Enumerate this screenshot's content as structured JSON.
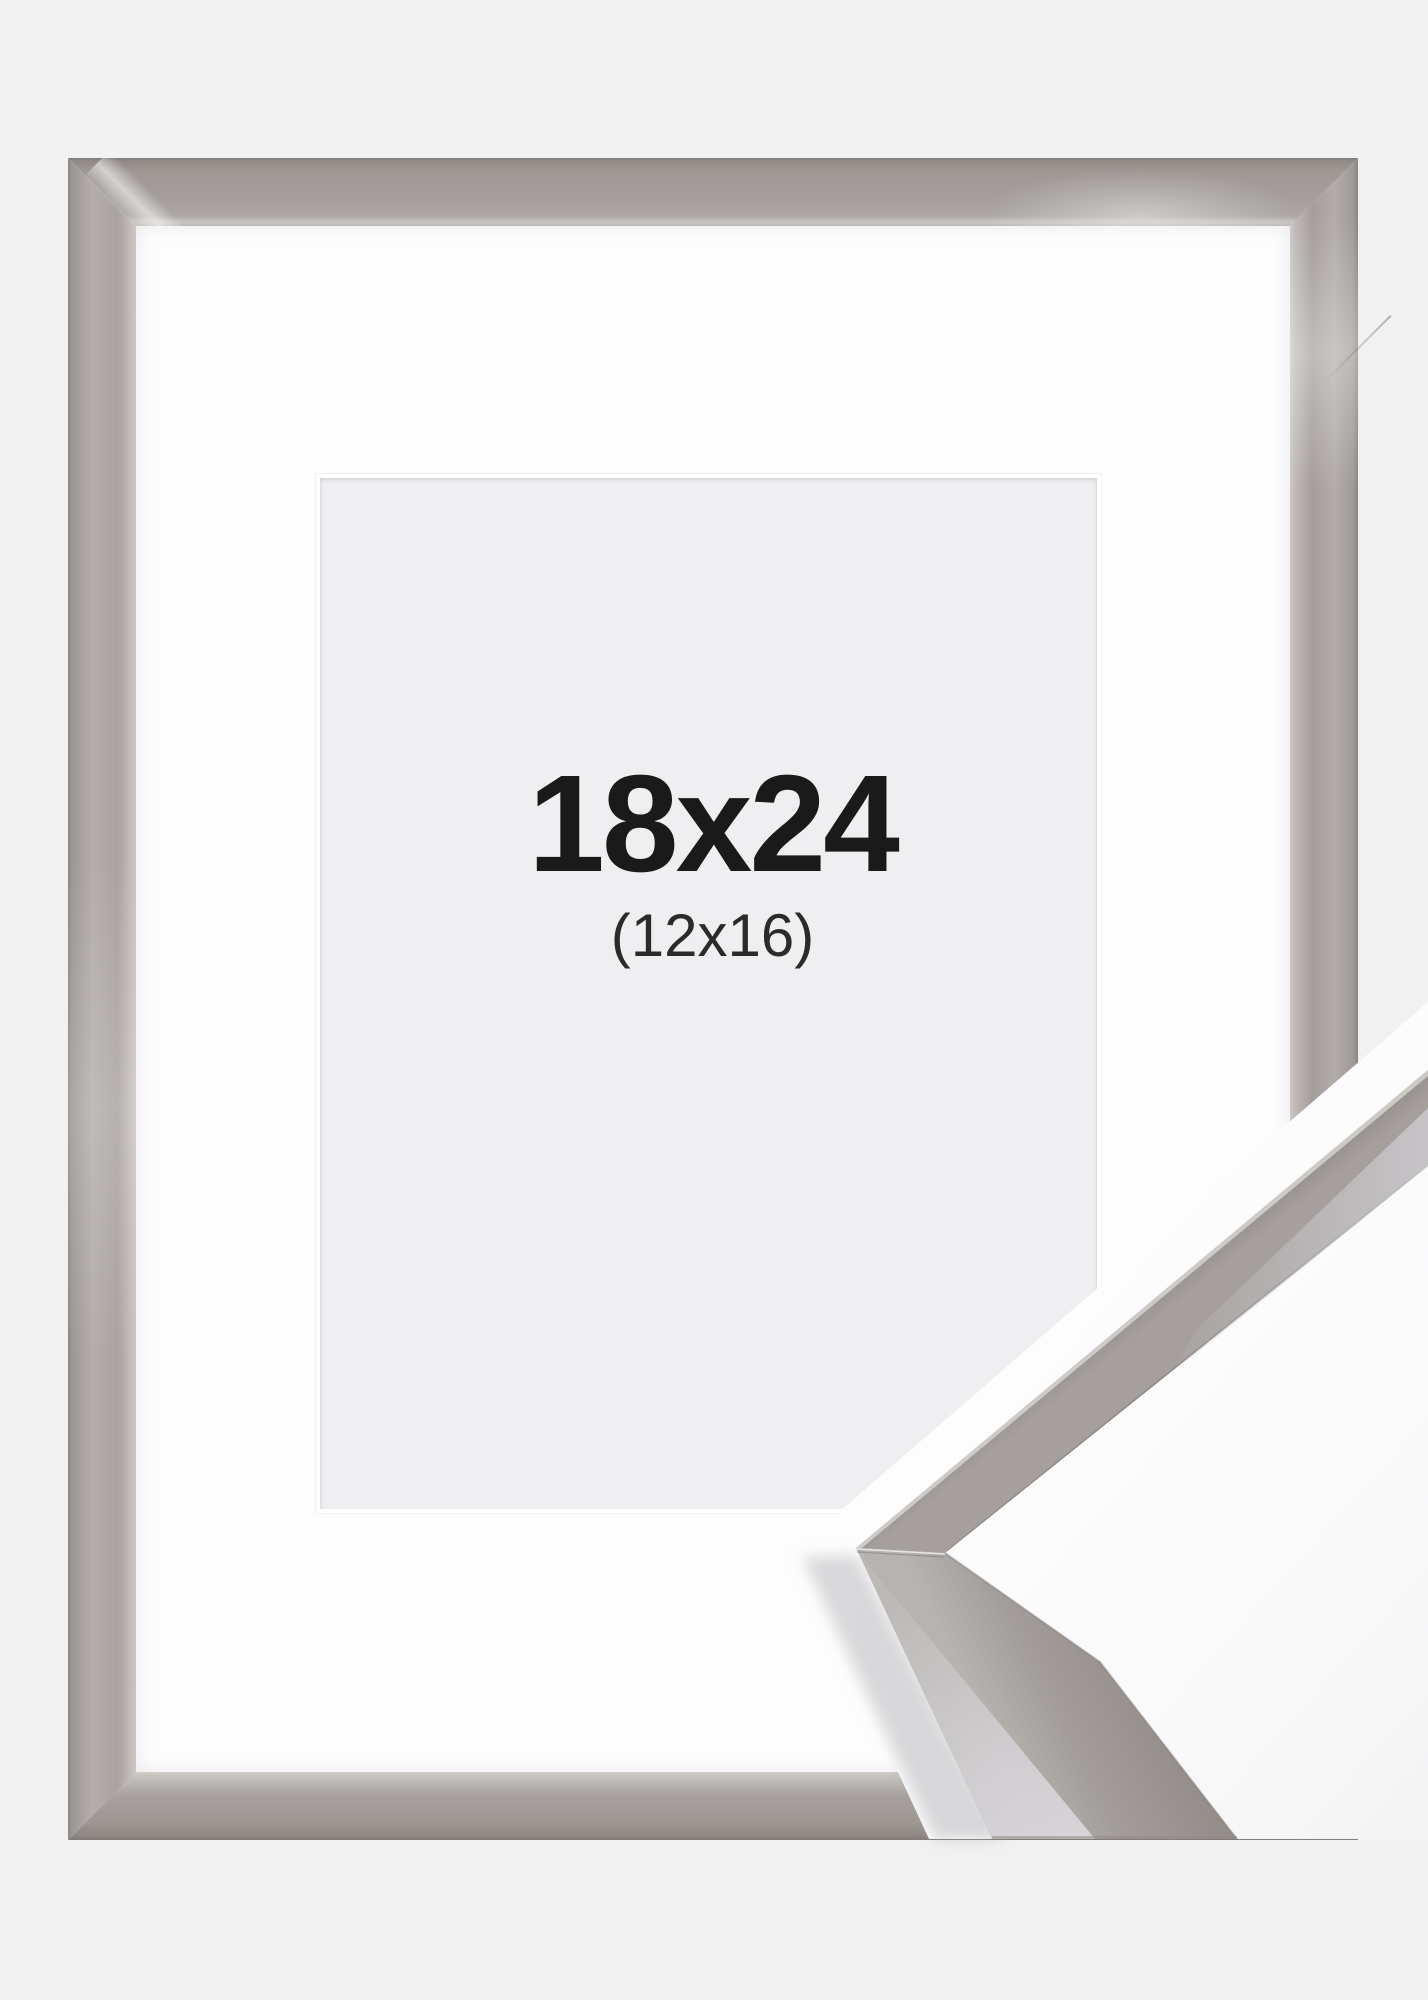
{
  "image": {
    "type": "picture-frame-product-photo",
    "size_label": "18x24",
    "inner_size_label": "(12x16)"
  },
  "colors": {
    "background": "#f1f1f2",
    "mat": "#fdfdfe",
    "opening": "#efeff1",
    "text": "#1a1a1a",
    "text-sub": "#2b2b2b",
    "frame-face": "#a5a09d",
    "frame-face-light": "#b3aeab",
    "frame-edge-dark": "#817b78",
    "frame-bevel-light": "#cac6c3",
    "moulding-pale-face": "#d6d4d8",
    "sample-backdrop": "#fdfdfe"
  }
}
